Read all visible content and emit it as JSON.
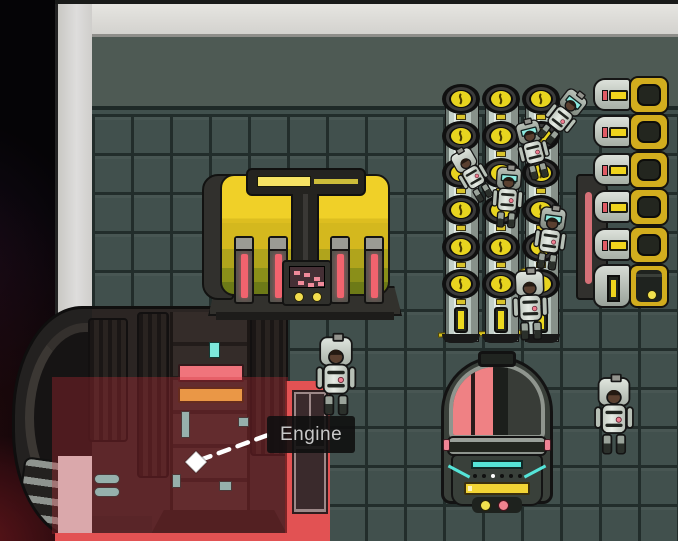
{
  "tooltip": {
    "label": "Engine"
  },
  "marker": {
    "x": 196,
    "y": 462
  },
  "colors": {
    "wall": "#d8d7d3",
    "floor_band": "#4e5a54",
    "floor_tile": "#41504d",
    "tile_grout": "#222d2b",
    "space": "#050406",
    "nebula_red": "#4a1016",
    "hull": "#2b2523",
    "accent_yellow": "#ecd11f",
    "accent_red": "#f0747c",
    "accent_teal": "#6ee8db",
    "selection_red": "#e25253",
    "selection_overlay": "rgba(210,45,58,0.30)",
    "tooltip_bg": "rgba(16,16,16,0.9)",
    "tooltip_text": "#c8c8c8"
  },
  "canisters": {
    "left_positions": [
      442,
      482,
      522
    ],
    "top": 84,
    "gauges_per_column": 6
  },
  "batteries": {
    "row_tops": [
      76,
      113,
      151,
      188,
      226
    ],
    "bottom_top": 264
  },
  "astronauts": [
    {
      "x": 446,
      "y": 134,
      "rot": -30,
      "scale": 0.62,
      "variant": "plain"
    },
    {
      "x": 508,
      "y": 108,
      "rot": -14,
      "scale": 0.66,
      "variant": "screen"
    },
    {
      "x": 541,
      "y": 76,
      "rot": 38,
      "scale": 0.66,
      "variant": "screen"
    },
    {
      "x": 484,
      "y": 155,
      "rot": 4,
      "scale": 0.68,
      "variant": "screen"
    },
    {
      "x": 527,
      "y": 196,
      "rot": 8,
      "scale": 0.7,
      "variant": "screen"
    },
    {
      "x": 506,
      "y": 262,
      "rot": -2,
      "scale": 0.78,
      "variant": "plain"
    },
    {
      "x": 312,
      "y": 332,
      "rot": 0,
      "scale": 0.88,
      "variant": "plain"
    },
    {
      "x": 590,
      "y": 372,
      "rot": 0,
      "scale": 0.86,
      "variant": "plain"
    }
  ]
}
